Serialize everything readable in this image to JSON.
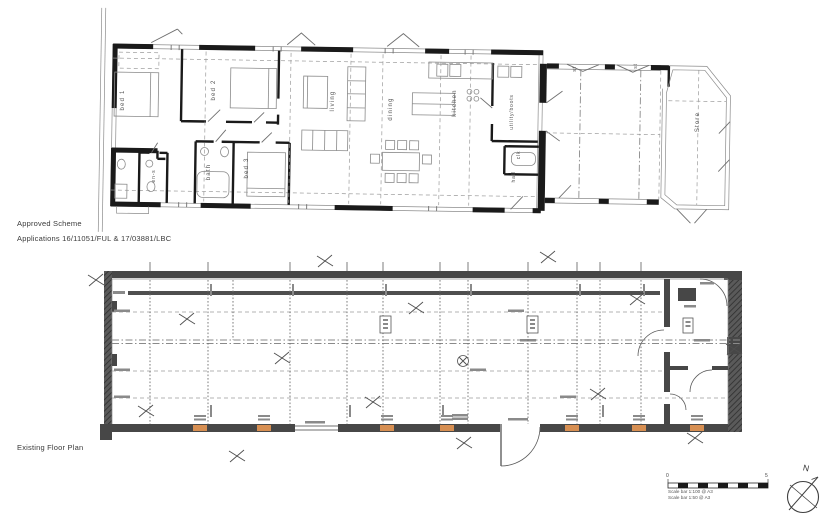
{
  "document": {
    "approved_scheme": {
      "title": "Approved Scheme",
      "applications": "Applications 16/11051/FUL & 17/03881/LBC",
      "rooms": {
        "bed1": "bed 1",
        "bed2": "bed 2",
        "bed3": "bed 3",
        "bath": "bath",
        "ens": "en-s",
        "living": "living",
        "dining": "dining",
        "kitchen": "kitchen",
        "utility": "utility/boots",
        "clk": "clk",
        "hall": "hall",
        "st1": "st",
        "st2": "st",
        "store": "Store"
      }
    },
    "existing_plan": {
      "title": "Existing Floor Plan"
    },
    "scale_bar": {
      "start": "0",
      "end": "5",
      "caption1": "Scale bar 1:100 @ A3",
      "caption2": "Scale bar 1:50 @ A3"
    },
    "north": {
      "label": "N"
    },
    "colors": {
      "paper": "#ffffff",
      "ink": "#3a3a3a",
      "wall_dark": "#474747",
      "line_gray": "#8c8c8c",
      "highlight_orange": "#d78f52"
    }
  }
}
